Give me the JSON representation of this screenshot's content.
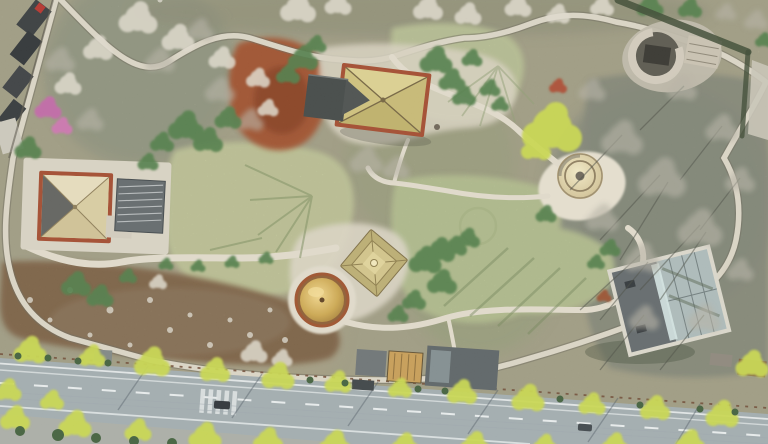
{
  "image": {
    "kind": "aerial-drone-photograph",
    "scene": "heritage park with pavilions, dome yurts, stone paths and a tree-lined road"
  },
  "palette": {
    "ground_base": "#b1ad90",
    "meadow_pale": "#cfd4a2",
    "lawn_green": "#c2ce9a",
    "scrub_brown": "#8a6c4c",
    "scrub_red": "#b25a30",
    "path_stone": "#d8d2c2",
    "wall_shadow": "#6a6557",
    "road_asphalt": "#9fa9ac",
    "road_marking": "#e6eaea",
    "tree_yellow": "#c6d44c",
    "tree_green": "#4e7a44",
    "tree_grey": "#b3afa1",
    "blossom_white": "#ddd8ca",
    "tree_pink": "#bd66a2",
    "roof_tan": "#cec27e",
    "roof_cream": "#ded2ac",
    "roof_trim_red": "#a0482a",
    "roof_dark": "#3f4442",
    "dome_gold": "#d4aa52",
    "dome_rim": "#9a4e28",
    "dome_tan": "#d9cda6",
    "building_grey": "#5f6668",
    "glass_blue": "#a9b7b6",
    "stone_grey": "#bdb6a6",
    "hedge_dark": "#3e5c38",
    "shadow_green": "#6f8054"
  },
  "features": [
    "central-hip-roof-pavilion",
    "west-pyramid-pavilion",
    "tiered-pagoda-pavilion",
    "golden-dome-yurt",
    "plaza-dome-yurt",
    "stone-ring-ruin",
    "glass-roof-building",
    "ribbed-roof-building",
    "roadside-buildings",
    "boundary-buildings",
    "perimeter-stone-wall",
    "winding-paths",
    "central-meadow",
    "lawn-circle-feature",
    "red-scrub-bed",
    "brown-scrub-slope",
    "tree-lined-road",
    "crosswalk",
    "cars"
  ]
}
